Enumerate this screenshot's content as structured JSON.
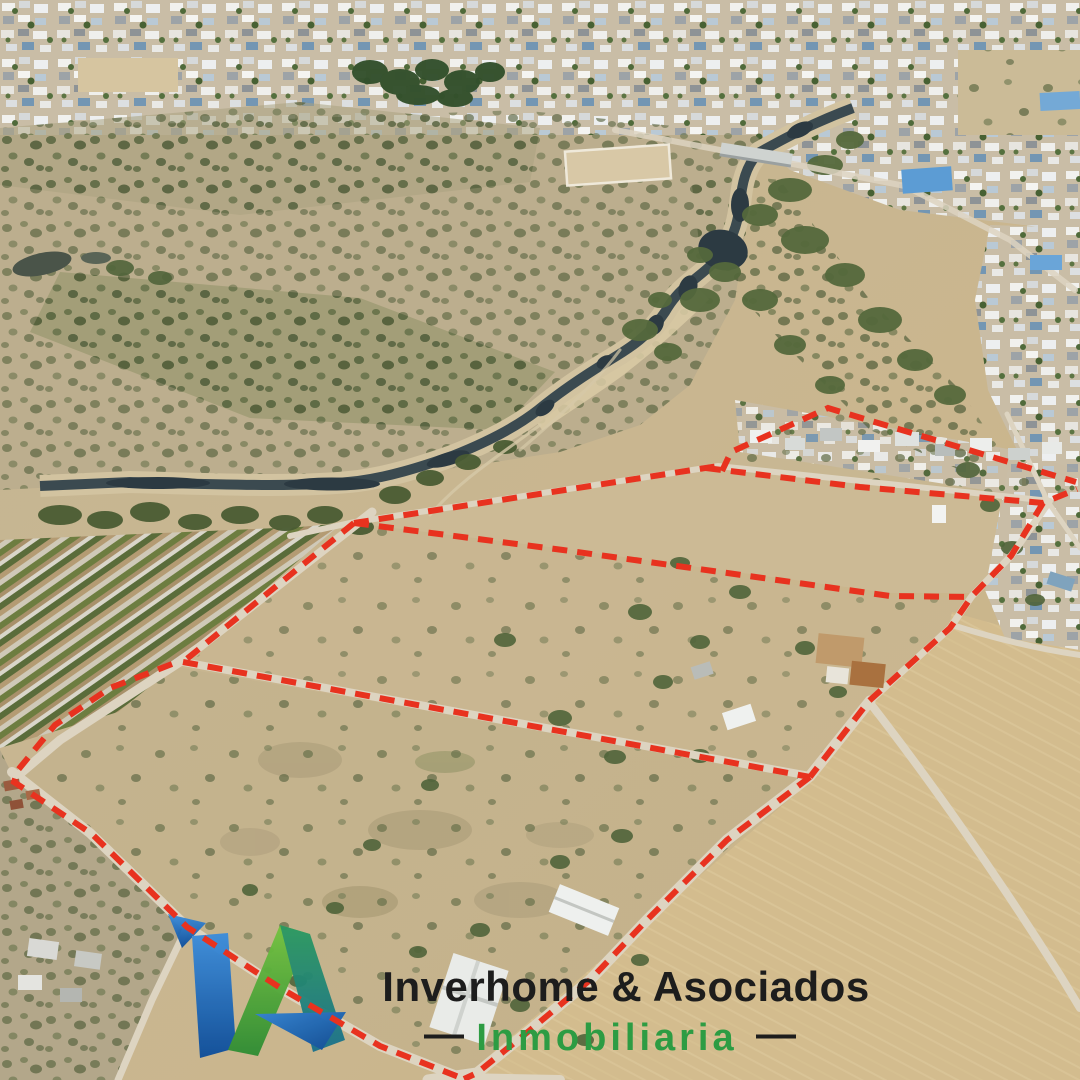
{
  "canvas": {
    "width": 1080,
    "height": 1080,
    "kind": "aerial-drone-photo-real-estate"
  },
  "watermark": {
    "brand": "Inverhome & Asociados",
    "tagline": "Inmobiliaria",
    "dash_left": "—",
    "dash_right": "—",
    "brand_color": "#1d1d1d",
    "tagline_color": "#2d9c43",
    "dash_color": "#1d1d1d",
    "monogram_colors": {
      "blue": "#3a8ddd",
      "blue_deep": "#0b4c9a",
      "green": "#74c43f",
      "green_deep": "#2d8c33",
      "teal": "#2a9a60",
      "teal_deep": "#19708d"
    }
  },
  "overlay": {
    "boundary_color": "#e8321f",
    "boundary_style": "dashed",
    "parcels_outlined": 4
  }
}
